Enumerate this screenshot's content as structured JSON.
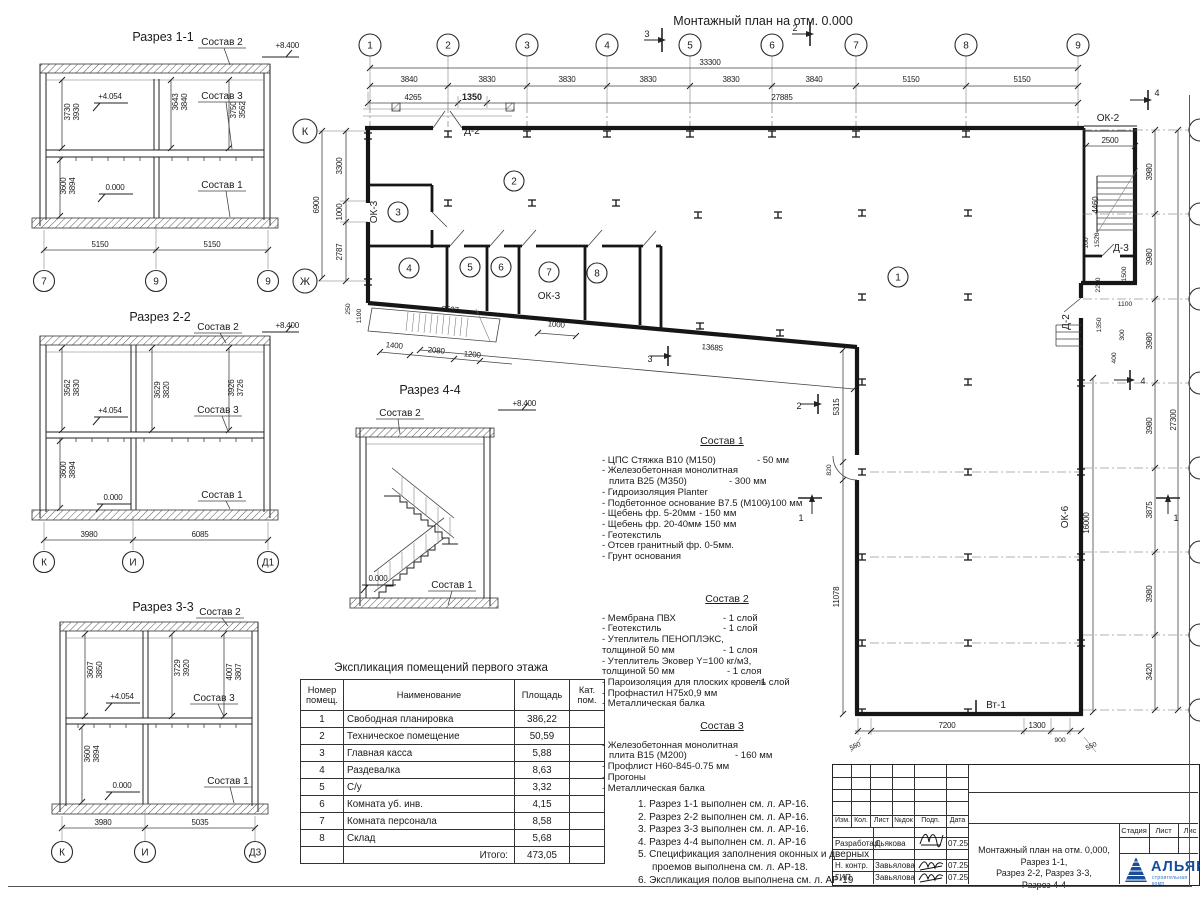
{
  "plan": {
    "title": "Монтажный план на отм. 0.000",
    "axes_top": [
      "1",
      "2",
      "3",
      "4",
      "5",
      "6",
      "7",
      "8",
      "9"
    ],
    "axes_left": [
      "К",
      "Ж"
    ],
    "top_dims": [
      "3840",
      "3830",
      "3830",
      "3830",
      "3830",
      "3840",
      "5150",
      "5150"
    ],
    "top_total": "33300",
    "sub_dims": [
      "4265",
      "1350",
      "27885"
    ],
    "left_dims": [
      "3300",
      "1000",
      "2787"
    ],
    "left_total": "6900",
    "left_small": [
      "250",
      "1100"
    ],
    "right_dims": [
      "3980",
      "3980",
      "3980",
      "3980",
      "3875",
      "3980",
      "3420"
    ],
    "right_total": "27300",
    "bottom_dims": [
      "550",
      "7200",
      "1300",
      "900",
      "550"
    ],
    "ramp_dims": [
      "1400",
      "2080",
      "1200",
      "8537",
      "1000"
    ],
    "diag_dim": "13685",
    "inner": {
      "d5315": "5315",
      "d820": "820",
      "d11078": "11078",
      "d16000": "16000",
      "d2500": "2500",
      "d4460": "4460",
      "d100": "100",
      "d1520": "1520",
      "d1500": "1500",
      "d2200": "2200",
      "d1100": "1100",
      "d1350": "1350",
      "d300": "300",
      "d400": "400"
    },
    "marks": {
      "m1": "1",
      "m2": "2",
      "m3": "3",
      "m4": "4"
    },
    "labels": {
      "ok2": "ОК-2",
      "ok3_left": "ОК-3",
      "ok3_bottom": "ОК-3",
      "ok6": "ОК-6",
      "d2_top": "Д-2",
      "d2_right": "Д-2",
      "d3": "Д-3",
      "vt1": "Вт-1"
    },
    "rooms": [
      "1",
      "2",
      "3",
      "4",
      "5",
      "6",
      "7",
      "8"
    ]
  },
  "s11": {
    "title": "Разрез 1-1",
    "axes": [
      "7",
      "9",
      "9"
    ],
    "elev_top": "+8.400",
    "elev_mid": "+4.054",
    "elev_zero": "0.000",
    "c1": "Состав 1",
    "c2": "Состав 2",
    "c3": "Состав 3",
    "dl": [
      "3730",
      "3930"
    ],
    "dm": [
      "3643",
      "3840"
    ],
    "dr": [
      "3750",
      "3562"
    ],
    "db": [
      "3600",
      "3894"
    ],
    "w": [
      "5150",
      "5150"
    ]
  },
  "s22": {
    "title": "Разрез 2-2",
    "axes": [
      "К",
      "И",
      "Д1"
    ],
    "elev_top": "+8.400",
    "elev_mid": "+4.054",
    "elev_zero": "0.000",
    "c1": "Состав 1",
    "c2": "Состав 2",
    "c3": "Состав 3",
    "dl": [
      "3562",
      "3830"
    ],
    "dm": [
      "3629",
      "3820"
    ],
    "dr": [
      "3926",
      "3726"
    ],
    "db": [
      "3600",
      "3894"
    ],
    "w": [
      "3980",
      "6085"
    ]
  },
  "s33": {
    "title": "Разрез 3-3",
    "axes": [
      "К",
      "И",
      "Д3"
    ],
    "elev_top": "+8.400",
    "elev_mid": "+4.054",
    "elev_zero": "0.000",
    "c1": "Состав 1",
    "c2": "Состав 2",
    "c3": "Состав 3",
    "dl": [
      "3607",
      "3850"
    ],
    "dm": [
      "3729",
      "3920"
    ],
    "dr": [
      "4007",
      "3807"
    ],
    "db": [
      "3600",
      "3894"
    ],
    "w": [
      "3980",
      "5035"
    ]
  },
  "s44": {
    "title": "Разрез 4-4",
    "elev_top": "+8.400",
    "elev_zero": "0.000",
    "c1": "Состав 1",
    "c2": "Состав 2"
  },
  "table": {
    "title": "Экспликация помещений первого этажа",
    "col_num": "Номер помещ.",
    "col_name": "Наименование",
    "col_area": "Площадь",
    "col_cat": "Кат. пом.",
    "rows": [
      [
        "1",
        "Свободная планировка",
        "386,22"
      ],
      [
        "2",
        "Техническое помещение",
        "50,59"
      ],
      [
        "3",
        "Главная касса",
        "5,88"
      ],
      [
        "4",
        "Раздевалка",
        "8,63"
      ],
      [
        "5",
        "С/у",
        "3,32"
      ],
      [
        "6",
        "Комната уб. инв.",
        "4,15"
      ],
      [
        "7",
        "Комната персонала",
        "8,58"
      ],
      [
        "8",
        "Склад",
        "5,68"
      ]
    ],
    "total_label": "Итого:",
    "total_value": "473,05"
  },
  "sostav1": {
    "title": "Состав 1",
    "items": [
      [
        "- ЦПС Стяжка В10 (М150)",
        "- 50 мм"
      ],
      [
        "- Железобетонная монолитная",
        ""
      ],
      [
        "плита В25 (М350)",
        "- 300 мм"
      ],
      [
        "- Гидроизоляция  Planter",
        ""
      ],
      [
        "- Подбетонное основание В7.5 (М100)",
        "- 100 мм"
      ],
      [
        "- Щебень фр. 5-20мм",
        "- 150 мм"
      ],
      [
        "- Щебень фр. 20-40мм",
        "- 150 мм"
      ],
      [
        "- Геотекстиль",
        ""
      ],
      [
        "- Отсев гранитный фр. 0-5мм.",
        ""
      ],
      [
        "- Грунт основания",
        ""
      ]
    ]
  },
  "sostav2": {
    "title": "Состав 2",
    "items": [
      [
        "- Мембрана ПВХ",
        "- 1 слой"
      ],
      [
        "- Геотекстиль",
        "- 1 слой"
      ],
      [
        "- Утеплитель ПЕНОПЛЭКС,",
        ""
      ],
      [
        "толщиной 50 мм",
        "- 1 слоя"
      ],
      [
        "- Утеплитель Эковер Y=100 кг/м3,",
        ""
      ],
      [
        "толщиной 50 мм",
        "- 1 слоя"
      ],
      [
        "- Пароизоляция для плоских кровель",
        "- 1 слой"
      ],
      [
        "- Профнастил Н75х0,9 мм",
        ""
      ],
      [
        "- Металлическая балка",
        ""
      ]
    ]
  },
  "sostav3": {
    "title": "Состав 3",
    "items": [
      [
        "- Железобетонная монолитная",
        ""
      ],
      [
        "плита В15 (М200)",
        "- 160 мм"
      ],
      [
        "- Профлист Н60-845-0.75 мм",
        ""
      ],
      [
        "- Прогоны",
        ""
      ],
      [
        "- Металлическая балка",
        ""
      ]
    ]
  },
  "notes": [
    "1. Разрез 1-1 выполнен см. л. АР-16.",
    "2. Разрез 2-2 выполнен см. л. АР-16.",
    "3. Разрез 3-3 выполнен см. л. АР-16.",
    "4. Разрез 4-4 выполнен см. л. АР-16",
    "5. Спецификация заполнения оконных и дверных",
    "проемов выполнена см. л. АР-18.",
    "6. Экспликация полов выполнена см. л. АР-19"
  ],
  "titleblock": {
    "cols": [
      "Изм.",
      "Кол.",
      "Лист",
      "№док",
      "Подп.",
      "Дата"
    ],
    "rows": [
      [
        "Разработал",
        "Дьякова",
        "07.25"
      ],
      [
        "Н. контр.",
        "Завьялова",
        "07.25"
      ],
      [
        "ГИП",
        "Завьялова",
        "07.25"
      ]
    ],
    "doc_title_1": "Монтажный план на отм. 0,000, Разрез 1-1,",
    "doc_title_2": "Разрез 2-2, Разрез 3-3,",
    "doc_title_3": "Разрез 4-4",
    "stage": "Стадия",
    "sheet": "Лист",
    "sheets": "Лис",
    "logo": "АЛЬЯН",
    "logo_sub": "строительная комп"
  }
}
